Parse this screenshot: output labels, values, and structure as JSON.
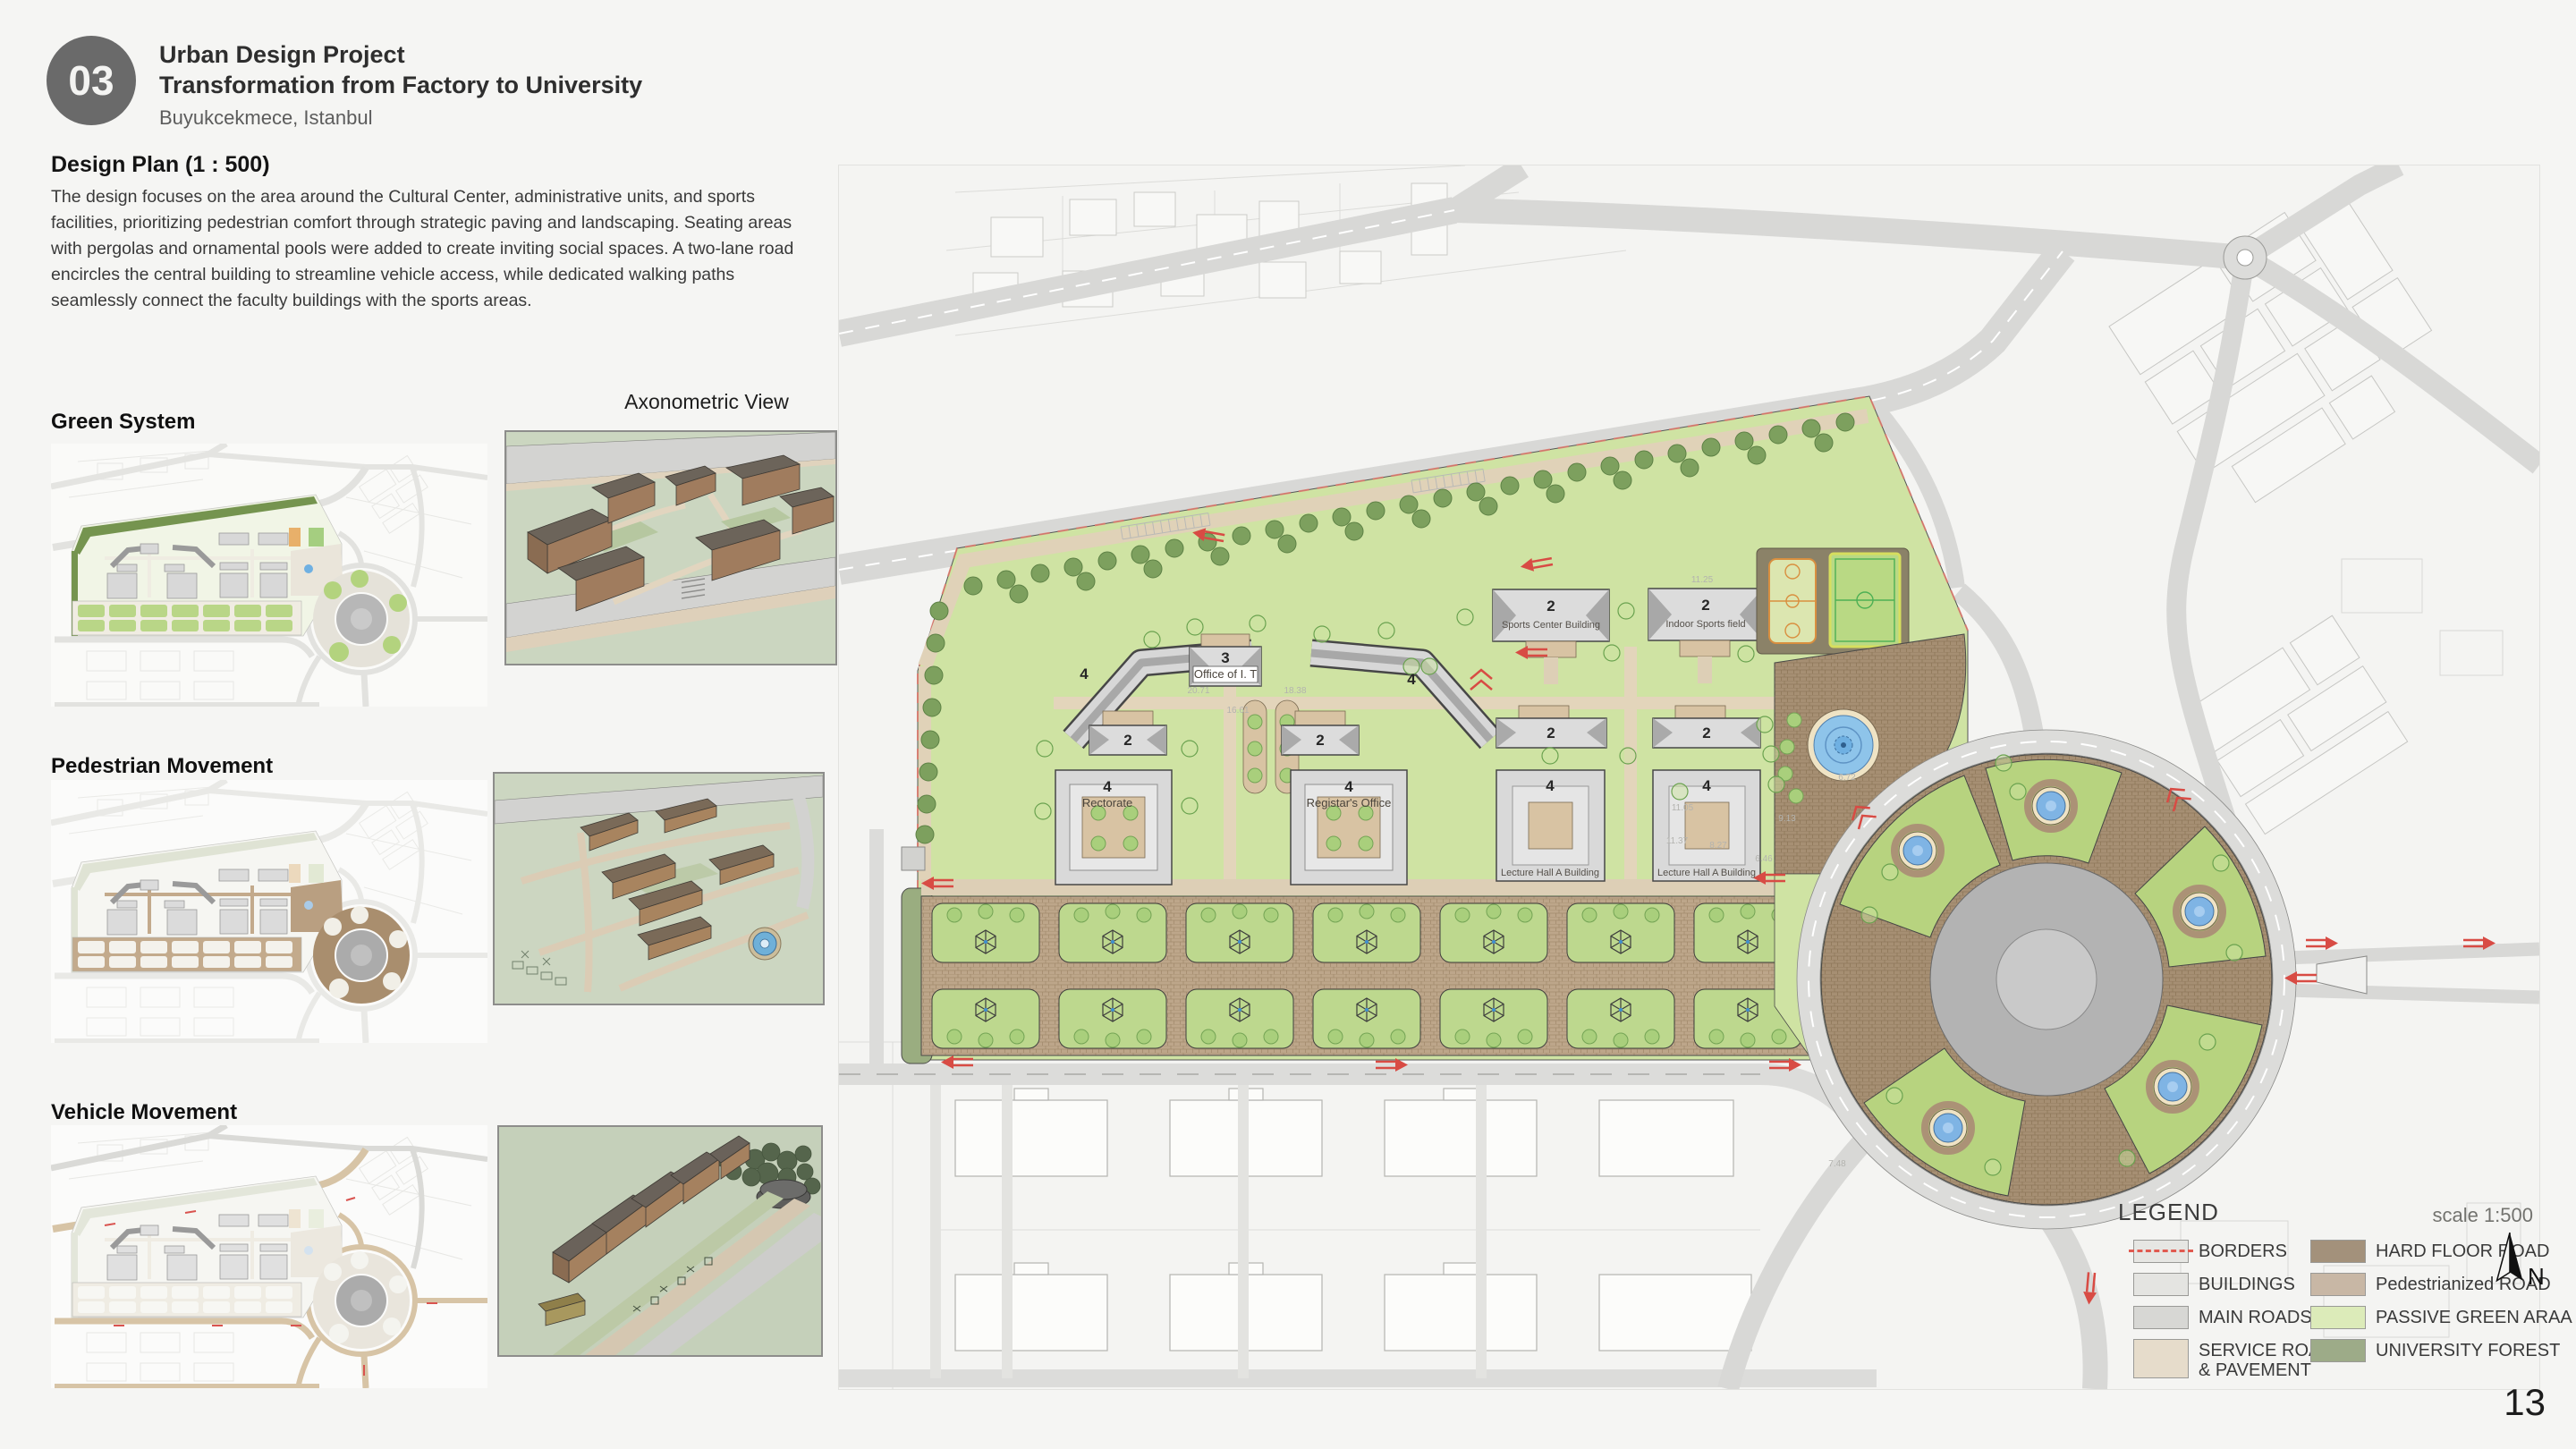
{
  "header": {
    "number": "03",
    "title": "Urban Design Project",
    "subtitle": "Transformation from Factory to University",
    "location": "Buyukcekmece, Istanbul"
  },
  "intro": {
    "heading": "Design Plan (1 : 500)",
    "body": "The design focuses on the area around the Cultural Center, administrative units, and sports facilities, prioritizing pedestrian comfort through strategic paving and landscaping. Seating areas with pergolas and ornamental pools were added to create inviting social spaces. A two-lane road encircles the central building to streamline vehicle access, while dedicated walking paths seamlessly connect the faculty buildings with the sports areas."
  },
  "sections": {
    "green_system": "Green System",
    "pedestrian_movement": "Pedestrian Movement",
    "vehicle_movement": "Vehicle Movement",
    "axonometric_view": "Axonometric View"
  },
  "plan": {
    "labels": {
      "office_it": "Office of I. T",
      "rectorate": "Rectorate",
      "registrar": "Registar's Office",
      "sports_center": "Sports Center Building",
      "indoor_sports": "Indoor Sports field",
      "lecture_hall": "Lecture Hall A Building"
    },
    "storeys": {
      "two": "2",
      "three": "3",
      "four": "4"
    },
    "dims": [
      "20.71",
      "18.38",
      "16.61",
      "11.25",
      "11.05",
      "11.37",
      "8.27",
      "6.46",
      "9.13",
      "6.72",
      "7.48"
    ]
  },
  "legend": {
    "title": "LEGEND",
    "scale": "scale 1:500",
    "north": "N",
    "items_left": [
      {
        "label": "BORDERS",
        "color": "#e6e6e3"
      },
      {
        "label": "BUILDINGS",
        "color": "#e4e4e1"
      },
      {
        "label": "MAIN ROADS",
        "color": "#d7d7d4"
      },
      {
        "label": "SERVICE ROADS",
        "label2": "&  PAVEMENT",
        "color": "#e6dccb"
      }
    ],
    "items_right": [
      {
        "label": "HARD FLOOR ROAD",
        "color": "#a3917b"
      },
      {
        "label": "Pedestrianized ROAD",
        "color": "#c8b7a5"
      },
      {
        "label": "PASSIVE GREEN ARAA",
        "color": "#dcebb9"
      },
      {
        "label": "UNIVERSITY FOREST",
        "color": "#9dab88"
      }
    ]
  },
  "page_number": "13",
  "colors": {
    "accent_red": "#d84b44",
    "pool_blue": "#7fb4e4",
    "campus_green": "#cfe3a3",
    "brick": "#b29b7e",
    "badge_gray": "#6a6a6a"
  }
}
